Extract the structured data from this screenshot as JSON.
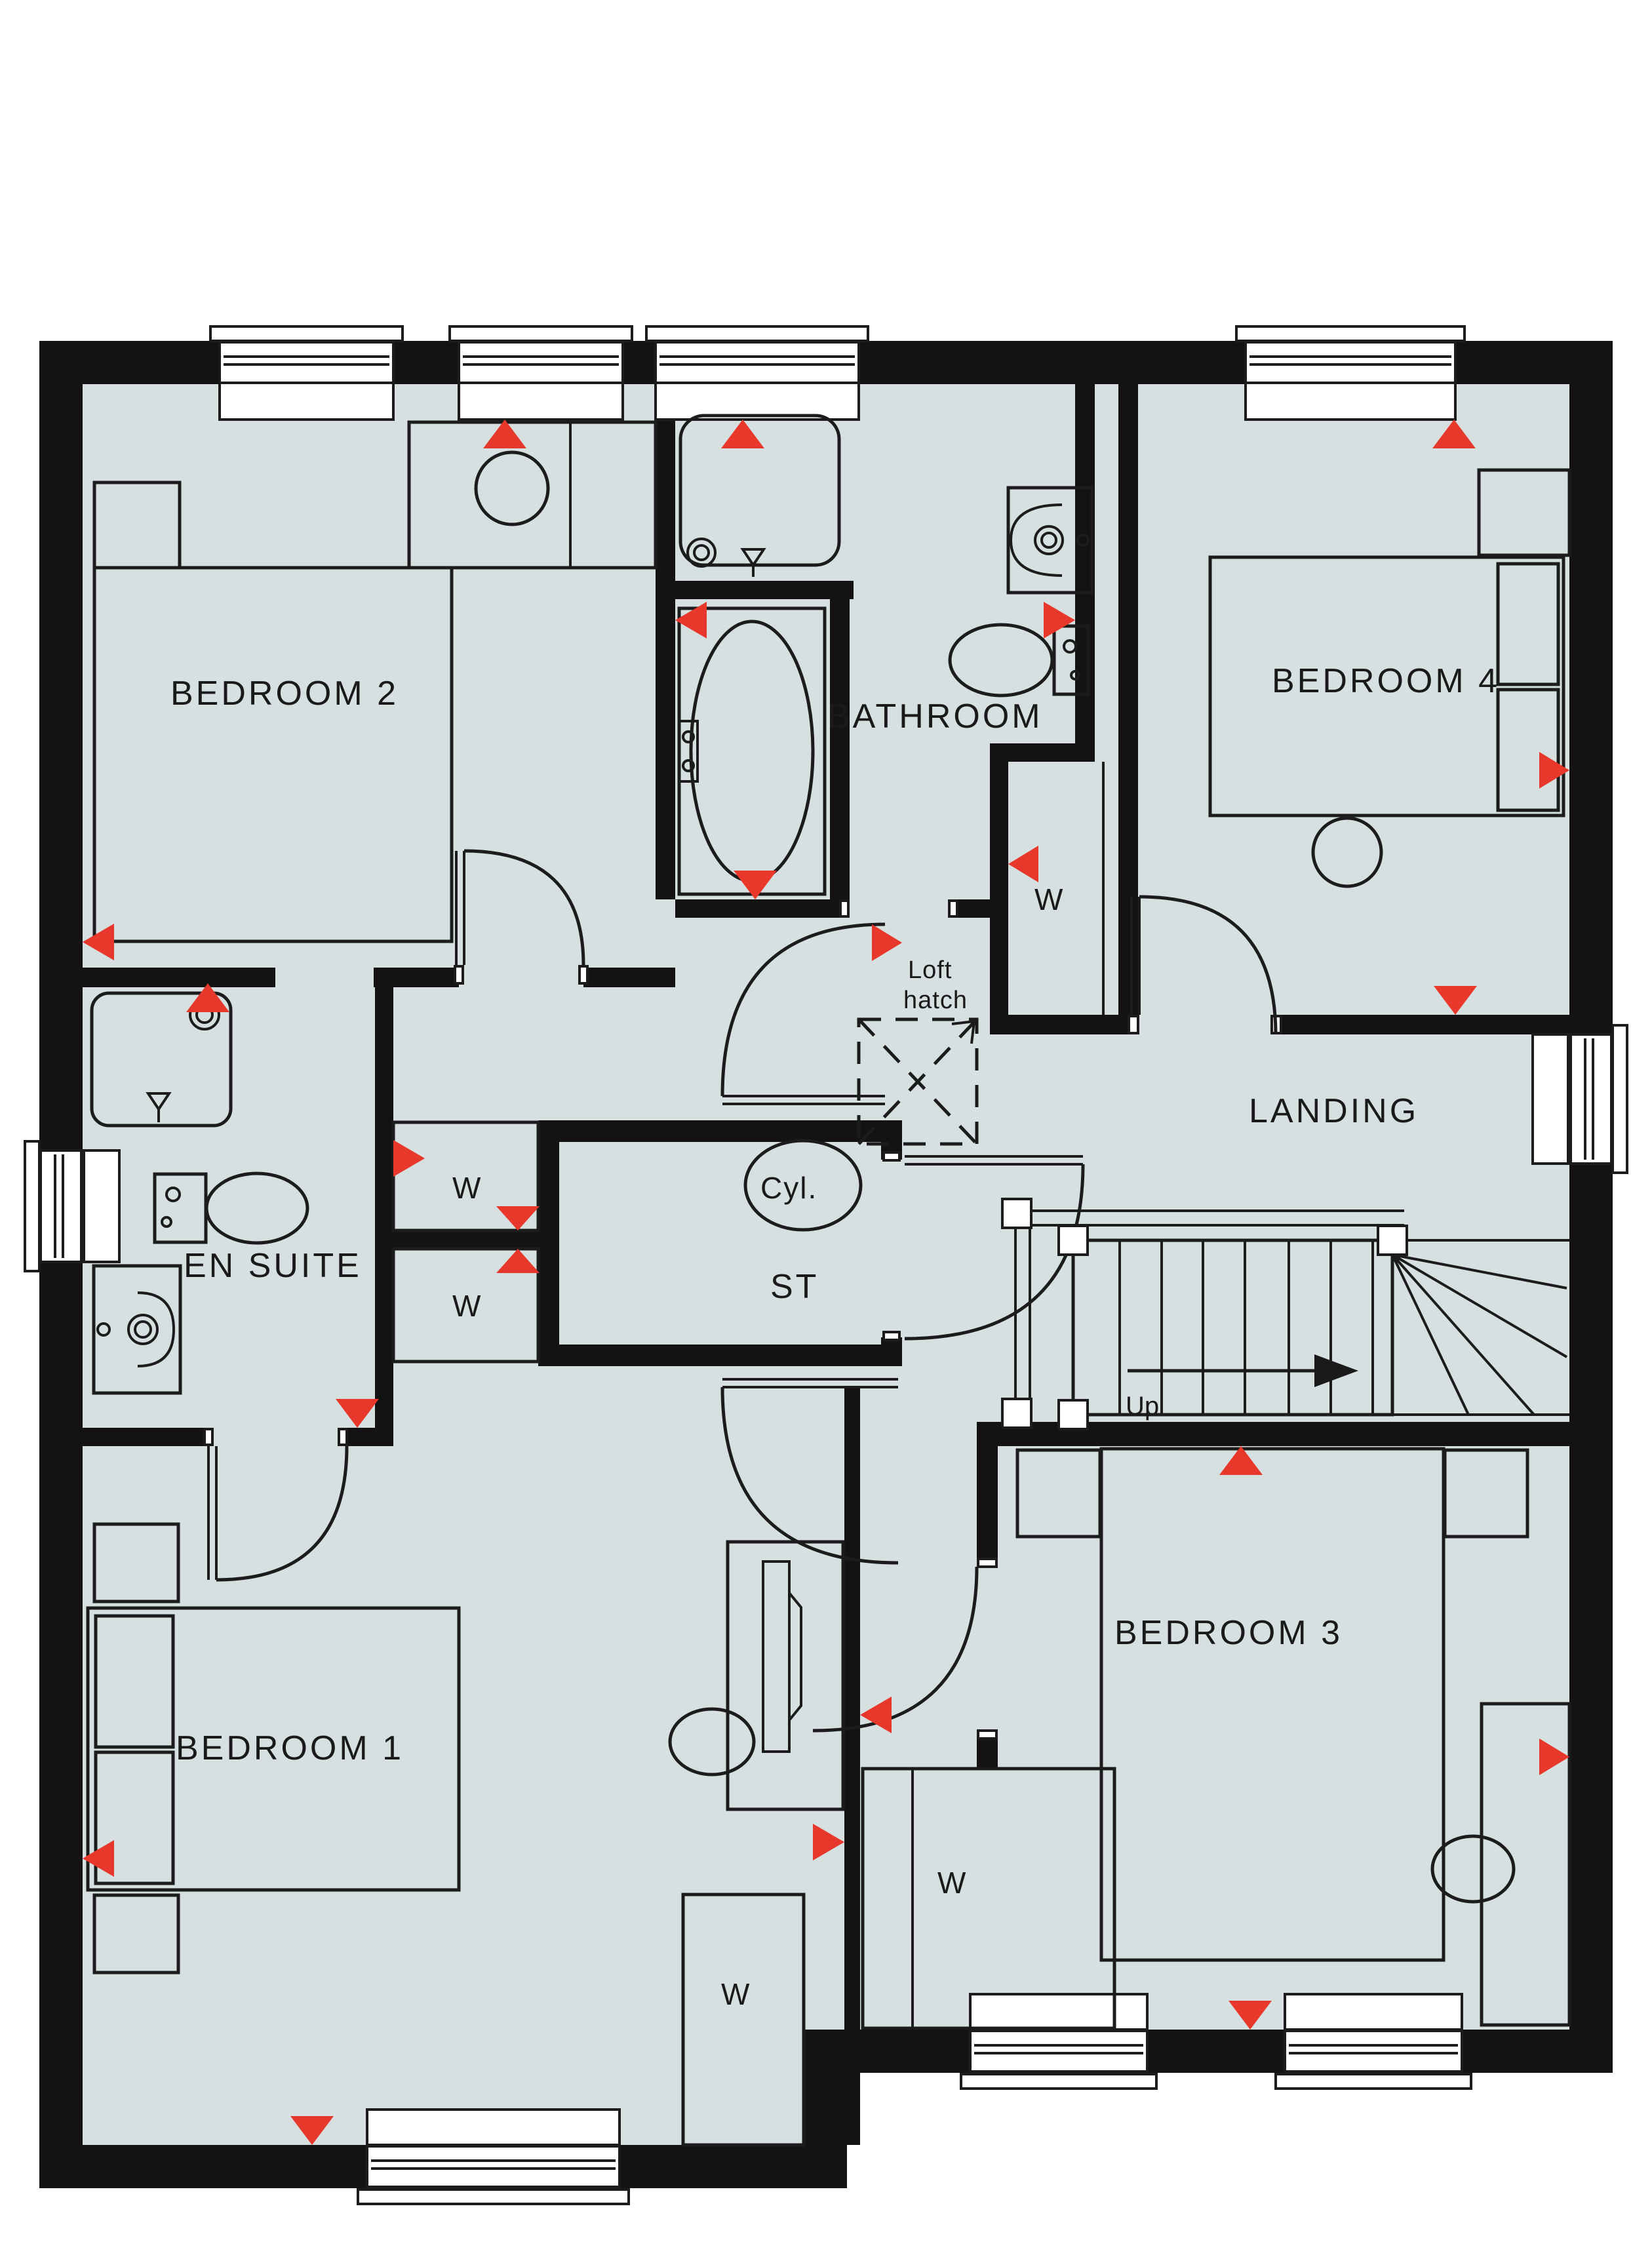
{
  "colors": {
    "floor": "#d6e0e0",
    "wall": "#131313",
    "line": "#1c1c1c",
    "marker_red": "#e8382c",
    "background": "#ffffff"
  },
  "rooms": {
    "bedroom1": "BEDROOM 1",
    "bedroom2": "BEDROOM 2",
    "bedroom3": "BEDROOM 3",
    "bedroom4": "BEDROOM 4",
    "bathroom": "BATHROOM",
    "ensuite": "EN SUITE",
    "landing": "LANDING",
    "store": "ST"
  },
  "labels": {
    "wardrobe": "W",
    "cylinder": "Cyl.",
    "up": "Up",
    "loft_line1": "Loft",
    "loft_line2": "hatch"
  },
  "icons": {
    "radiator_marker": "red-triangle-radiator-icon",
    "loft_hatch": "loft-hatch-dashed-icon",
    "stairs_up_arrow": "up-direction-arrow-icon"
  }
}
